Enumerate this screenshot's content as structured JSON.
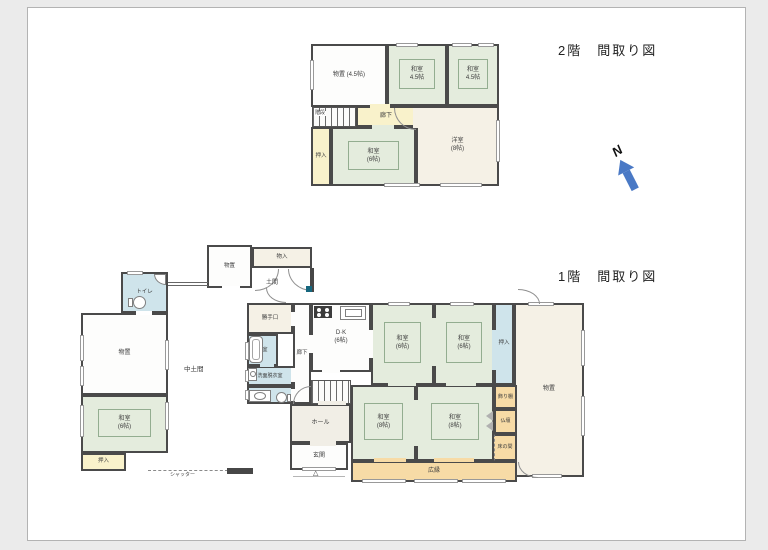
{
  "titles": {
    "floor2": "2階　間取り図",
    "floor1": "1階　間取り図"
  },
  "north": {
    "label": "N"
  },
  "palette": {
    "wall": "#4a4a4a",
    "tatami": "#e4ecdd",
    "tatami_line": "#93ad90",
    "corridor_yellow": "#f9f2cb",
    "water_blue": "#cfe4eb",
    "veranda_orange": "#f7dba6",
    "storage_cream": "#f5f1e6",
    "hall_cream": "#f1eee6",
    "north_blue": "#4a79c5",
    "paper": "#ffffff",
    "background": "#ebebeb",
    "pillar_teal": "#16677e"
  },
  "floors": [
    {
      "id": "floor2",
      "rooms": [
        {
          "name": "room-2f-storage",
          "label": "物置 (4.5帖)",
          "x": 311,
          "y": 44,
          "w": 76,
          "h": 63,
          "fill": "white",
          "fs": 6
        },
        {
          "name": "room-2f-washitsu-a",
          "label": "和室",
          "label2": "4.5帖",
          "x": 387,
          "y": 44,
          "w": 60,
          "h": 62,
          "fill": "tatami",
          "fs": 6
        },
        {
          "name": "room-2f-washitsu-b",
          "label": "和室",
          "label2": "4.5帖",
          "x": 447,
          "y": 44,
          "w": 52,
          "h": 62,
          "fill": "tatami",
          "fs": 6
        },
        {
          "name": "room-2f-corridor",
          "label": "廊下",
          "x": 356,
          "y": 106,
          "w": 60,
          "h": 21,
          "fill": "yellow",
          "fs": 6
        },
        {
          "name": "room-2f-oshiire",
          "label": "押入",
          "x": 311,
          "y": 127,
          "w": 20,
          "h": 59,
          "fill": "yellow",
          "fs": 5.5
        },
        {
          "name": "room-2f-washitsu-c",
          "label": "和室",
          "label2": "(6帖)",
          "x": 331,
          "y": 127,
          "w": 85,
          "h": 59,
          "fill": "tatami",
          "fs": 6
        },
        {
          "name": "room-2f-yoshitsu",
          "label": "洋室",
          "label2": "(8帖)",
          "x": 416,
          "y": 106,
          "w": 83,
          "h": 80,
          "fill": "cream",
          "fs": 6
        }
      ],
      "stairs": [
        {
          "name": "stairs-2f",
          "x": 312,
          "y": 107,
          "w": 44,
          "h": 20
        }
      ],
      "windows": [
        [
          396,
          43,
          22,
          4
        ],
        [
          452,
          43,
          20,
          4
        ],
        [
          478,
          43,
          16,
          4
        ],
        [
          496,
          120,
          4,
          42
        ],
        [
          384,
          183,
          36,
          4
        ],
        [
          440,
          183,
          42,
          4
        ],
        [
          310,
          60,
          4,
          30
        ]
      ],
      "gaps": [
        [
          372,
          125,
          22,
          4,
          "#e4ecdd"
        ],
        [
          370,
          104,
          20,
          4,
          "#f9f2cb"
        ],
        [
          413,
          108,
          5,
          20,
          "#f5f1e6"
        ]
      ],
      "doors": [
        [
          394,
          108,
          22,
          22,
          "tr"
        ]
      ],
      "icons": [],
      "extras": [],
      "annotations": [
        {
          "name": "label-2f-stairs",
          "text": "階段",
          "x": 314,
          "y": 111,
          "fs": 5,
          "bg": true
        }
      ]
    },
    {
      "id": "floor1",
      "rooms": [
        {
          "name": "room-1f-toilet",
          "label": "トイレ",
          "x": 121,
          "y": 272,
          "w": 47,
          "h": 41,
          "fill": "blue",
          "fs": 5.5
        },
        {
          "name": "room-1f-storage-left",
          "label": "物置",
          "x": 81,
          "y": 313,
          "w": 87,
          "h": 82,
          "fill": "white",
          "fs": 6
        },
        {
          "name": "room-1f-washitsu-left",
          "label": "和室",
          "label2": "(6帖)",
          "x": 81,
          "y": 395,
          "w": 87,
          "h": 58,
          "fill": "tatami",
          "fs": 6
        },
        {
          "name": "room-1f-oshiire-left",
          "label": "押入",
          "x": 81,
          "y": 453,
          "w": 45,
          "h": 18,
          "fill": "yellow",
          "fs": 5.5
        },
        {
          "name": "room-1f-storage-top",
          "label": "物置",
          "x": 207,
          "y": 245,
          "w": 45,
          "h": 43,
          "fill": "white",
          "fs": 5.5
        },
        {
          "name": "room-1f-monoire",
          "label": "物入",
          "x": 252,
          "y": 247,
          "w": 60,
          "h": 21,
          "fill": "cream",
          "fs": 5.5
        },
        {
          "name": "room-1f-katteguchi",
          "label": "勝手口",
          "x": 247,
          "y": 303,
          "w": 46,
          "h": 31,
          "fill": "cream",
          "fs": 5.5
        },
        {
          "name": "room-1f-bathroom",
          "label": "浴室",
          "x": 247,
          "y": 334,
          "w": 31,
          "h": 32,
          "fill": "blue",
          "fs": 5
        },
        {
          "name": "room-1f-senmen",
          "label": "洗面脱衣室",
          "x": 247,
          "y": 366,
          "w": 46,
          "h": 20,
          "fill": "blue",
          "fs": 5
        },
        {
          "name": "room-1f-toilet2",
          "label": "",
          "x": 247,
          "y": 386,
          "w": 46,
          "h": 18,
          "fill": "blue",
          "fs": 5
        },
        {
          "name": "room-1f-corridor",
          "label": "廊下",
          "x": 293,
          "y": 303,
          "w": 18,
          "h": 101,
          "fill": "white",
          "fs": 5.5
        },
        {
          "name": "room-1f-dk",
          "label": "D·K",
          "label2": "(6帖)",
          "x": 311,
          "y": 303,
          "w": 60,
          "h": 69,
          "fill": "white",
          "fs": 6
        },
        {
          "name": "room-1f-hall",
          "label": "ホール",
          "x": 290,
          "y": 404,
          "w": 61,
          "h": 39,
          "fill": "hall",
          "fs": 6
        },
        {
          "name": "room-1f-genkan",
          "label": "玄関",
          "x": 290,
          "y": 443,
          "w": 58,
          "h": 27,
          "fill": "white",
          "fs": 6
        },
        {
          "name": "room-1f-washitsu-6a",
          "label": "和室",
          "label2": "(6帖)",
          "x": 371,
          "y": 303,
          "w": 63,
          "h": 82,
          "fill": "tatami",
          "fs": 6
        },
        {
          "name": "room-1f-washitsu-6b",
          "label": "和室",
          "label2": "(6帖)",
          "x": 434,
          "y": 303,
          "w": 60,
          "h": 82,
          "fill": "tatami",
          "fs": 6
        },
        {
          "name": "room-1f-oshiire-right",
          "label": "押入",
          "x": 494,
          "y": 303,
          "w": 20,
          "h": 82,
          "fill": "blue",
          "fs": 5.5
        },
        {
          "name": "room-1f-storage-right",
          "label": "物置",
          "x": 514,
          "y": 303,
          "w": 70,
          "h": 174,
          "fill": "cream",
          "fs": 6
        },
        {
          "name": "room-1f-washitsu-8a",
          "label": "和室",
          "label2": "(8帖)",
          "x": 351,
          "y": 385,
          "w": 65,
          "h": 76,
          "fill": "tatami",
          "fs": 6
        },
        {
          "name": "room-1f-washitsu-8b",
          "label": "和室",
          "label2": "(8帖)",
          "x": 416,
          "y": 385,
          "w": 78,
          "h": 76,
          "fill": "tatami",
          "fs": 6
        },
        {
          "name": "room-1f-kazaridana",
          "label": "飾り棚",
          "x": 494,
          "y": 385,
          "w": 23,
          "h": 24,
          "fill": "orange",
          "fs": 5
        },
        {
          "name": "room-1f-butsudan",
          "label": "仏壇",
          "x": 494,
          "y": 409,
          "w": 23,
          "h": 25,
          "fill": "orange",
          "fs": 5
        },
        {
          "name": "room-1f-tokonoma",
          "label": "床の間",
          "x": 494,
          "y": 434,
          "w": 23,
          "h": 27,
          "fill": "orange",
          "fs": 5,
          "cls": "dash-l"
        },
        {
          "name": "room-1f-hiroen",
          "label": "広縁",
          "x": 351,
          "y": 461,
          "w": 166,
          "h": 21,
          "fill": "orange",
          "fs": 6
        }
      ],
      "stairs": [
        {
          "name": "stairs-1f",
          "x": 311,
          "y": 380,
          "w": 40,
          "h": 24
        }
      ],
      "windows": [
        [
          127,
          271,
          16,
          4
        ],
        [
          80,
          335,
          4,
          26
        ],
        [
          80,
          366,
          4,
          20
        ],
        [
          165,
          340,
          4,
          30
        ],
        [
          80,
          405,
          4,
          32
        ],
        [
          165,
          402,
          4,
          28
        ],
        [
          388,
          302,
          22,
          4
        ],
        [
          450,
          302,
          24,
          4
        ],
        [
          528,
          302,
          26,
          4
        ],
        [
          581,
          330,
          4,
          36
        ],
        [
          581,
          396,
          4,
          40
        ],
        [
          532,
          474,
          30,
          4
        ],
        [
          362,
          479,
          44,
          4
        ],
        [
          414,
          479,
          44,
          4
        ],
        [
          462,
          479,
          44,
          4
        ],
        [
          245,
          342,
          4,
          18
        ],
        [
          245,
          370,
          4,
          12
        ],
        [
          245,
          390,
          4,
          10
        ],
        [
          302,
          467,
          34,
          4
        ]
      ],
      "gaps": [
        [
          136,
          311,
          16,
          4,
          "#ffffff"
        ],
        [
          222,
          286,
          18,
          4,
          "#ffffff"
        ],
        [
          322,
          369,
          18,
          4,
          "#fdfdfc"
        ],
        [
          369,
          330,
          4,
          28,
          "#fdfdfc"
        ],
        [
          432,
          318,
          4,
          48,
          "#e4ecdd"
        ],
        [
          414,
          400,
          4,
          46,
          "#e4ecdd"
        ],
        [
          388,
          382,
          28,
          4,
          "#e4ecdd"
        ],
        [
          446,
          382,
          30,
          4,
          "#e4ecdd"
        ],
        [
          374,
          458,
          32,
          4,
          "#f7dba6"
        ],
        [
          434,
          458,
          40,
          4,
          "#f7dba6"
        ],
        [
          310,
          441,
          26,
          5,
          "#f1eee6"
        ],
        [
          318,
          401,
          28,
          4,
          "#f1eee6"
        ],
        [
          291,
          389,
          4,
          12,
          "#fdfdfc"
        ],
        [
          291,
          368,
          4,
          14,
          "#fdfdfc"
        ],
        [
          291,
          312,
          4,
          14,
          "#fdfdfc"
        ],
        [
          260,
          363,
          14,
          4,
          "#cfe4eb"
        ],
        [
          309,
          335,
          4,
          18,
          "#fdfdfc"
        ],
        [
          492,
          330,
          4,
          40,
          "#cfe4eb"
        ]
      ],
      "doors": [
        [
          255,
          269,
          24,
          22,
          "tl"
        ],
        [
          288,
          269,
          24,
          22,
          "tr"
        ],
        [
          266,
          288,
          20,
          15,
          "tr"
        ],
        [
          293,
          386,
          18,
          18,
          "br"
        ],
        [
          518,
          289,
          22,
          15,
          "bl"
        ],
        [
          518,
          462,
          20,
          16,
          "tr"
        ]
      ],
      "icons": [
        {
          "type": "rect",
          "name": "toilet-tank-icon",
          "x": 128,
          "y": 298,
          "w": 5,
          "h": 9
        },
        {
          "type": "ellipse",
          "name": "toilet-bowl-icon",
          "x": 133,
          "y": 296,
          "w": 13,
          "h": 13
        },
        {
          "type": "quarter",
          "name": "corner-sink-icon",
          "x": 154,
          "y": 274,
          "w": 12,
          "h": 11
        },
        {
          "type": "tub",
          "name": "bathtub-icon",
          "x": 249,
          "y": 336,
          "w": 14,
          "h": 27
        },
        {
          "type": "rect",
          "name": "washing-machine-icon",
          "x": 248,
          "y": 368,
          "w": 9,
          "h": 13
        },
        {
          "type": "ellipse",
          "name": "washer-drum-icon",
          "x": 250,
          "y": 371,
          "w": 6,
          "h": 6
        },
        {
          "type": "rect",
          "name": "vanity-icon",
          "x": 249,
          "y": 390,
          "w": 22,
          "h": 12
        },
        {
          "type": "ellipse",
          "name": "vanity-basin-icon",
          "x": 254,
          "y": 392,
          "w": 12,
          "h": 8
        },
        {
          "type": "ellipse",
          "name": "toilet2-bowl-icon",
          "x": 276,
          "y": 392,
          "w": 11,
          "h": 11
        },
        {
          "type": "rect",
          "name": "toilet2-tank-icon",
          "x": 287,
          "y": 394,
          "w": 4,
          "h": 8
        },
        {
          "type": "stove",
          "name": "stove-icon",
          "x": 314,
          "y": 306,
          "w": 18,
          "h": 12
        },
        {
          "type": "rect",
          "name": "kitchen-sink-icon",
          "x": 340,
          "y": 306,
          "w": 26,
          "h": 14
        },
        {
          "type": "rect",
          "name": "sink-basin-icon",
          "x": 345,
          "y": 309,
          "w": 17,
          "h": 8
        },
        {
          "type": "fold",
          "name": "folding-door-icon",
          "x": 486,
          "y": 411,
          "w": 8,
          "h": 21
        },
        {
          "type": "teal",
          "name": "pillar-marker",
          "x": 306,
          "y": 286,
          "w": 6,
          "h": 6
        }
      ],
      "extras": [
        {
          "type": "fence",
          "name": "connecting-wall",
          "x": 168,
          "y": 282,
          "w": 40,
          "h": 4
        },
        {
          "type": "wallseg",
          "name": "wall-segment",
          "x": 310,
          "y": 268,
          "w": 4,
          "h": 24
        },
        {
          "type": "wallseg",
          "name": "wall-segment",
          "x": 227,
          "y": 468,
          "w": 26,
          "h": 6
        },
        {
          "type": "dashed",
          "name": "shutter-line",
          "x": 148,
          "y": 470,
          "w": 80,
          "h": 2
        },
        {
          "type": "thinline",
          "name": "porch-line",
          "x": 293,
          "y": 476,
          "w": 52,
          "h": 1
        }
      ],
      "annotations": [
        {
          "name": "label-nakadoma",
          "text": "中土間",
          "x": 184,
          "y": 367,
          "fs": 6.5
        },
        {
          "name": "label-doma",
          "text": "土間",
          "x": 266,
          "y": 280,
          "fs": 6
        },
        {
          "name": "label-shutter",
          "text": "シャッター",
          "x": 170,
          "y": 473,
          "fs": 5
        },
        {
          "name": "entrance-marker",
          "text": "△",
          "x": 313,
          "y": 470,
          "fs": 7
        }
      ]
    }
  ]
}
